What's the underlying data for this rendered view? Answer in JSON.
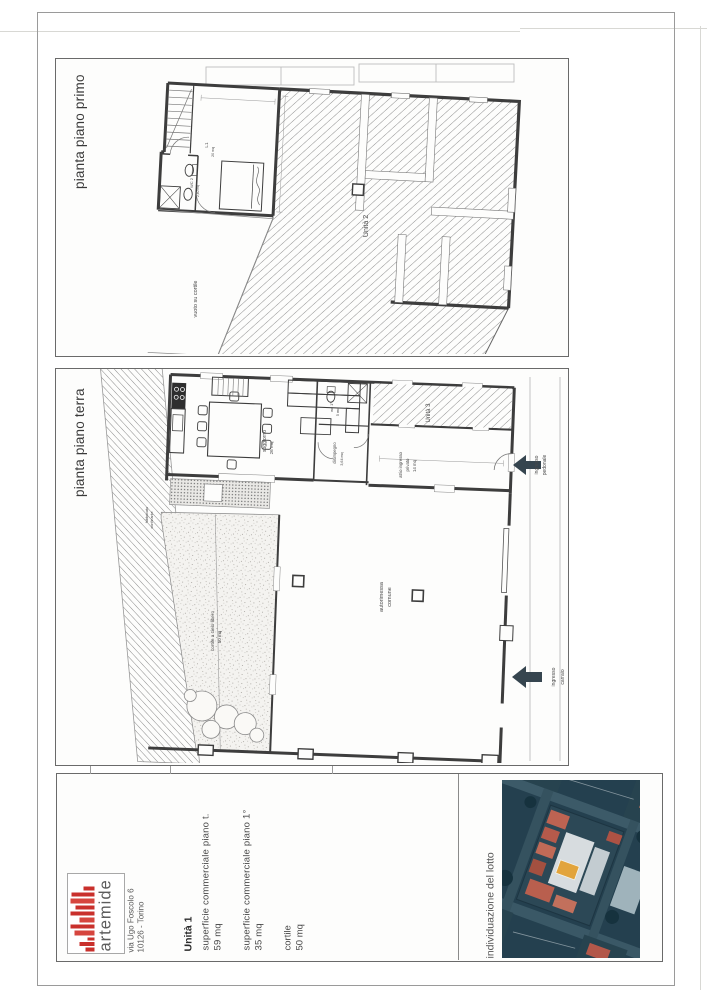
{
  "panel_primo": {
    "title": "pianta piano primo",
    "unita2": "Unità 2",
    "vuoto": "vuoto su cortile",
    "room_l1": "L1",
    "room_l1_mq": "20 mq",
    "wc2": "WC 2",
    "wc2_mq": "2,60 mq"
  },
  "panel_terra": {
    "title": "pianta piano terra",
    "unita3": "Unità 3",
    "atrio_1": "atrio ingresso",
    "atrio_2": "privato",
    "atrio_3": "14 mq",
    "pedonale_1": "ingresso",
    "pedonale_2": "pedonale",
    "carraio_1": "ingresso",
    "carraio_2": "carraio",
    "autorimessa_1": "autorimessa",
    "autorimessa_2": "comune",
    "cortile_1": "cortile a cielo libero",
    "cortile_2": "50 mq",
    "soggiorno": "soggiorno",
    "soggiorno_mq": "26 mq",
    "disimpegno": "disimpegno",
    "disimpegno_mq": "3,64 mq",
    "wc1": "wc 1°",
    "wc1_mq": "5 mq",
    "confine_1": "fabbricato",
    "confine_2": "confinante"
  },
  "title_block": {
    "logo": "artemide",
    "address_1": "via Ugo Foscolo 6",
    "address_2": "10126 - Torino",
    "unit": "Unità 1",
    "row1_label": "superficie commerciale piano t.",
    "row1_value": "59 mq",
    "row2_label": "superficie commerciale piano 1°",
    "row2_value": "35 mq",
    "row3_label": "cortile",
    "row3_value": "50 mq",
    "lotto": "individuazione del lotto"
  },
  "colors": {
    "logo_red": "#c9302c",
    "arrow": "#36454f",
    "lot_highlight": "#e2a43c"
  }
}
